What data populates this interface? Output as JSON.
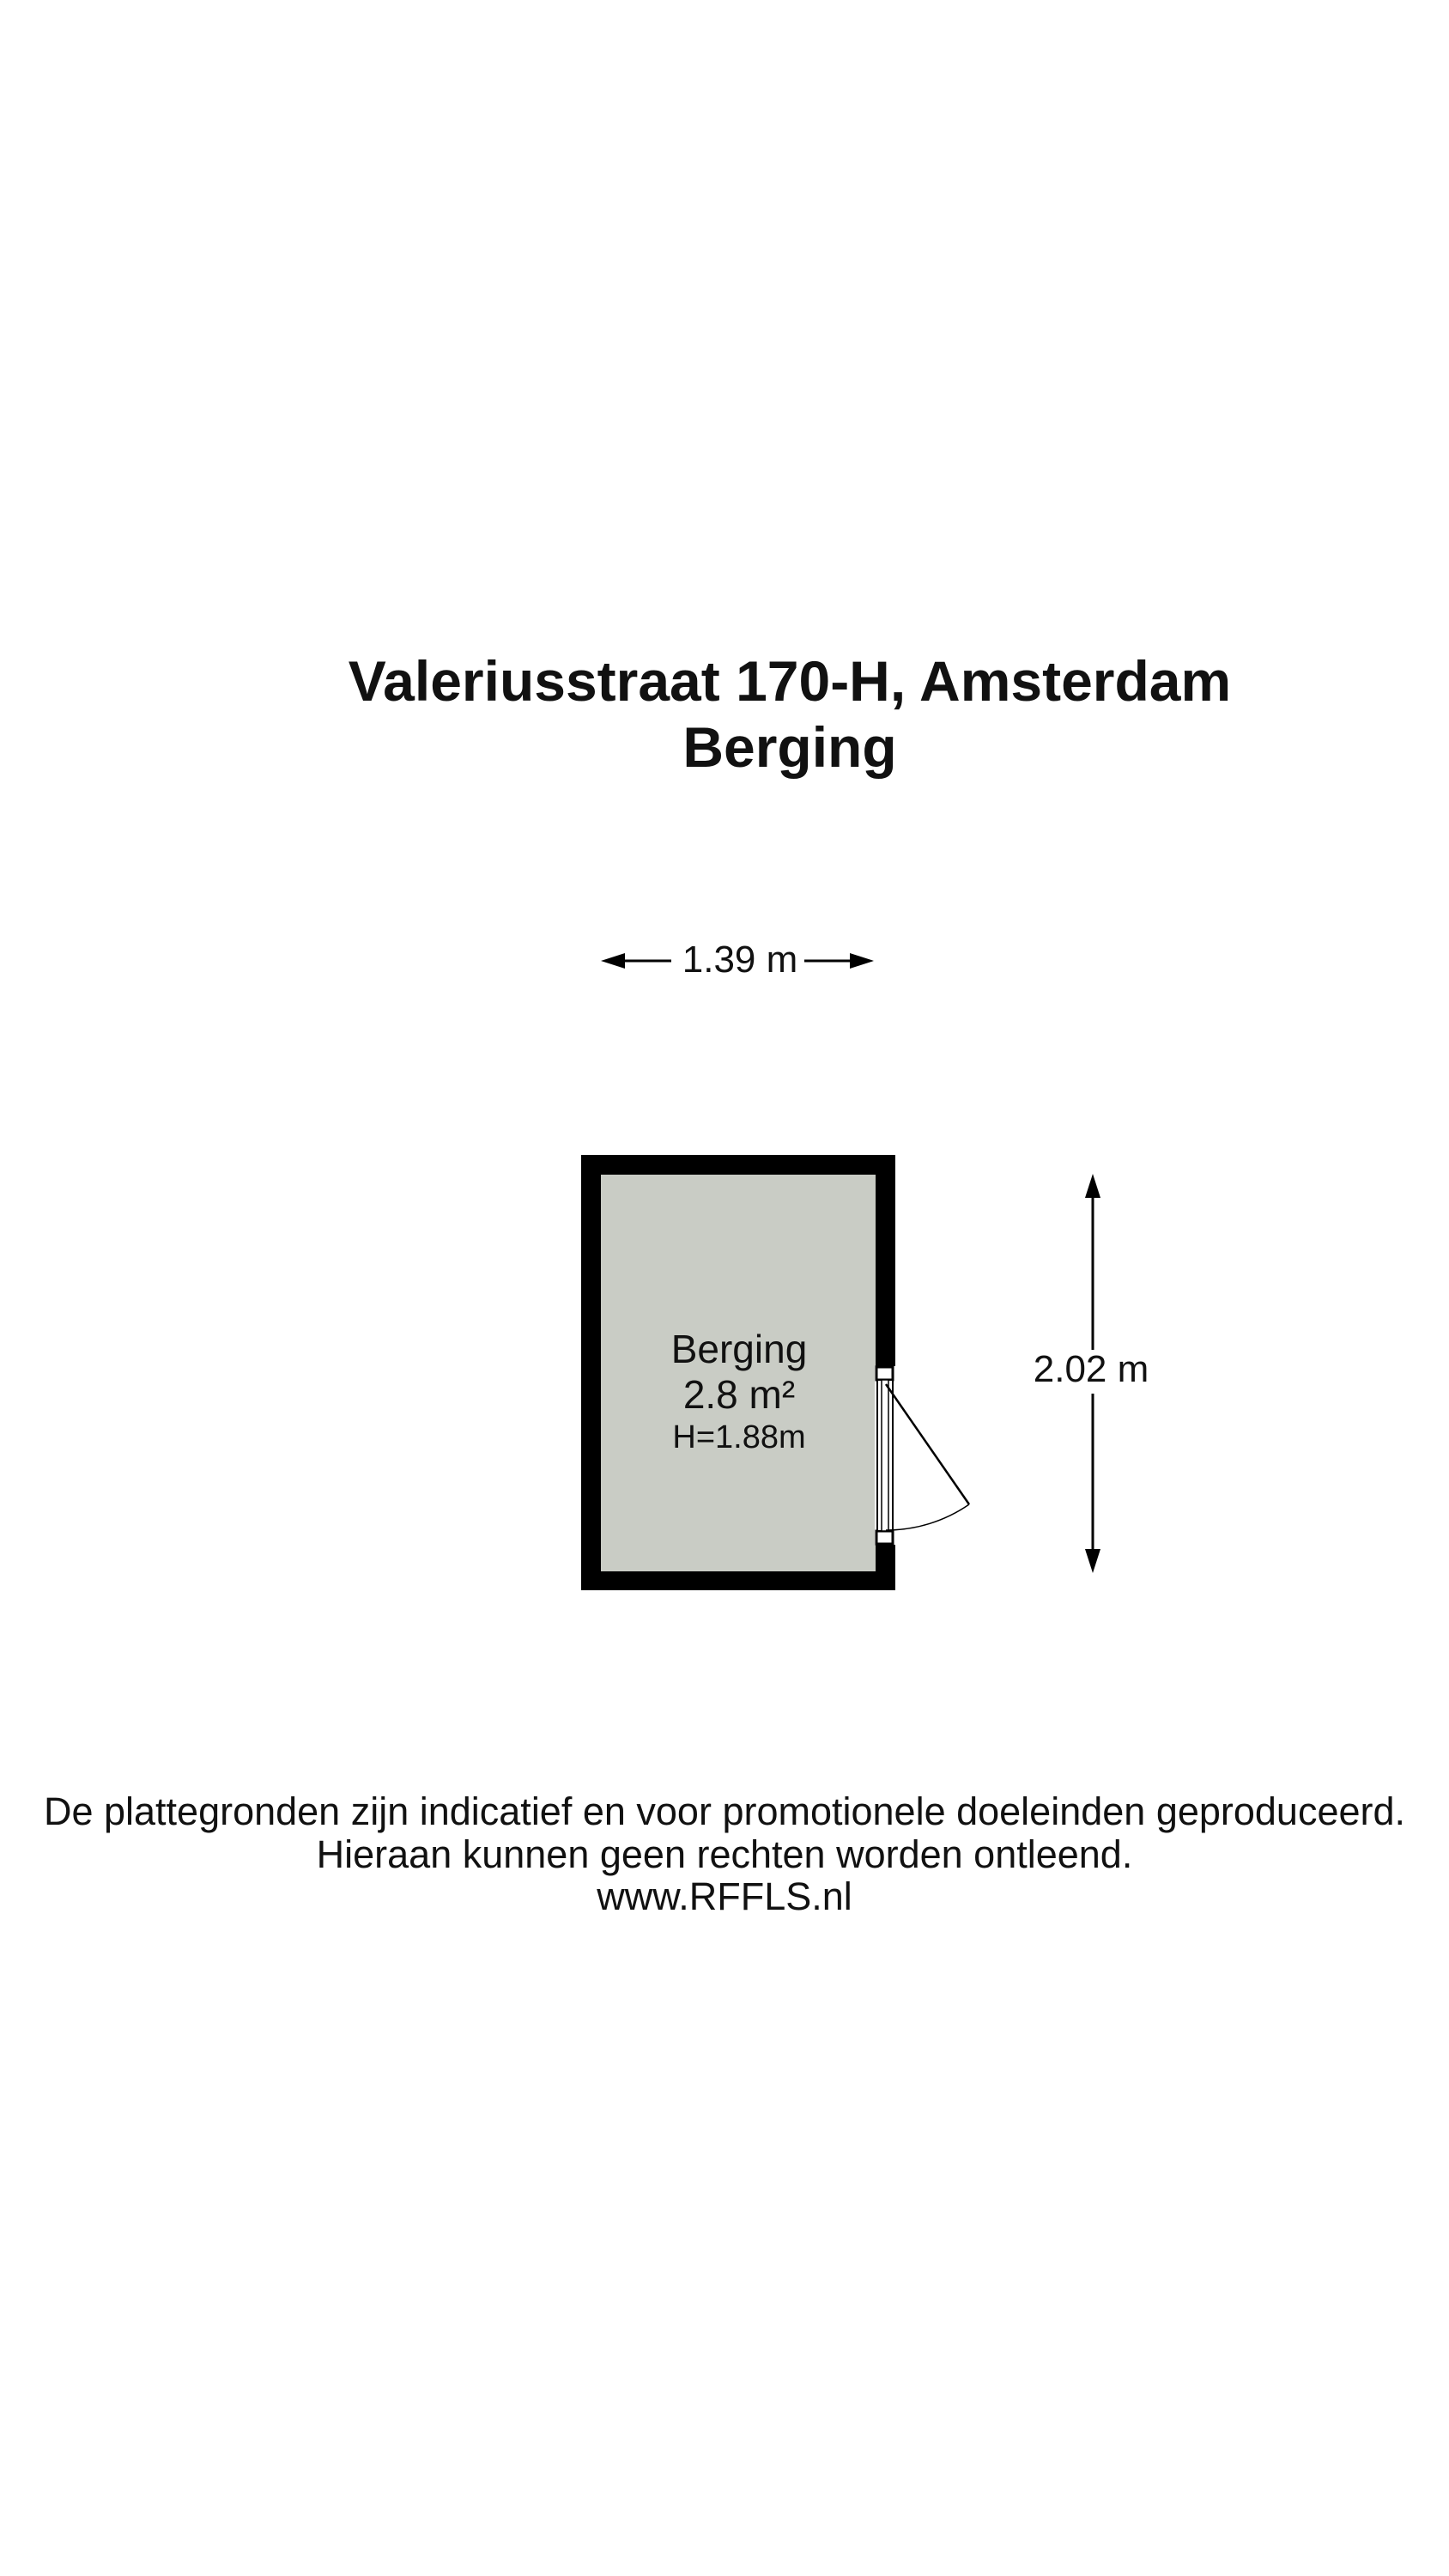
{
  "title": {
    "line1": "Valeriusstraat 170-H, Amsterdam",
    "line2": "Berging"
  },
  "floorplan": {
    "room": {
      "name": "Berging",
      "area": "2.8 m²",
      "ceiling_height": "H=1.88m"
    },
    "dimensions": {
      "width_label": "1.39 m",
      "height_label": "2.02 m"
    },
    "colors": {
      "wall": "#000000",
      "floor": "#c9ccc5",
      "background": "#ffffff",
      "line": "#111111"
    }
  },
  "footer": {
    "line1": "De plattegronden zijn indicatief en voor promotionele doeleinden geproduceerd.",
    "line2": "Hieraan kunnen geen rechten worden ontleend.",
    "line3": "www.RFFLS.nl"
  }
}
